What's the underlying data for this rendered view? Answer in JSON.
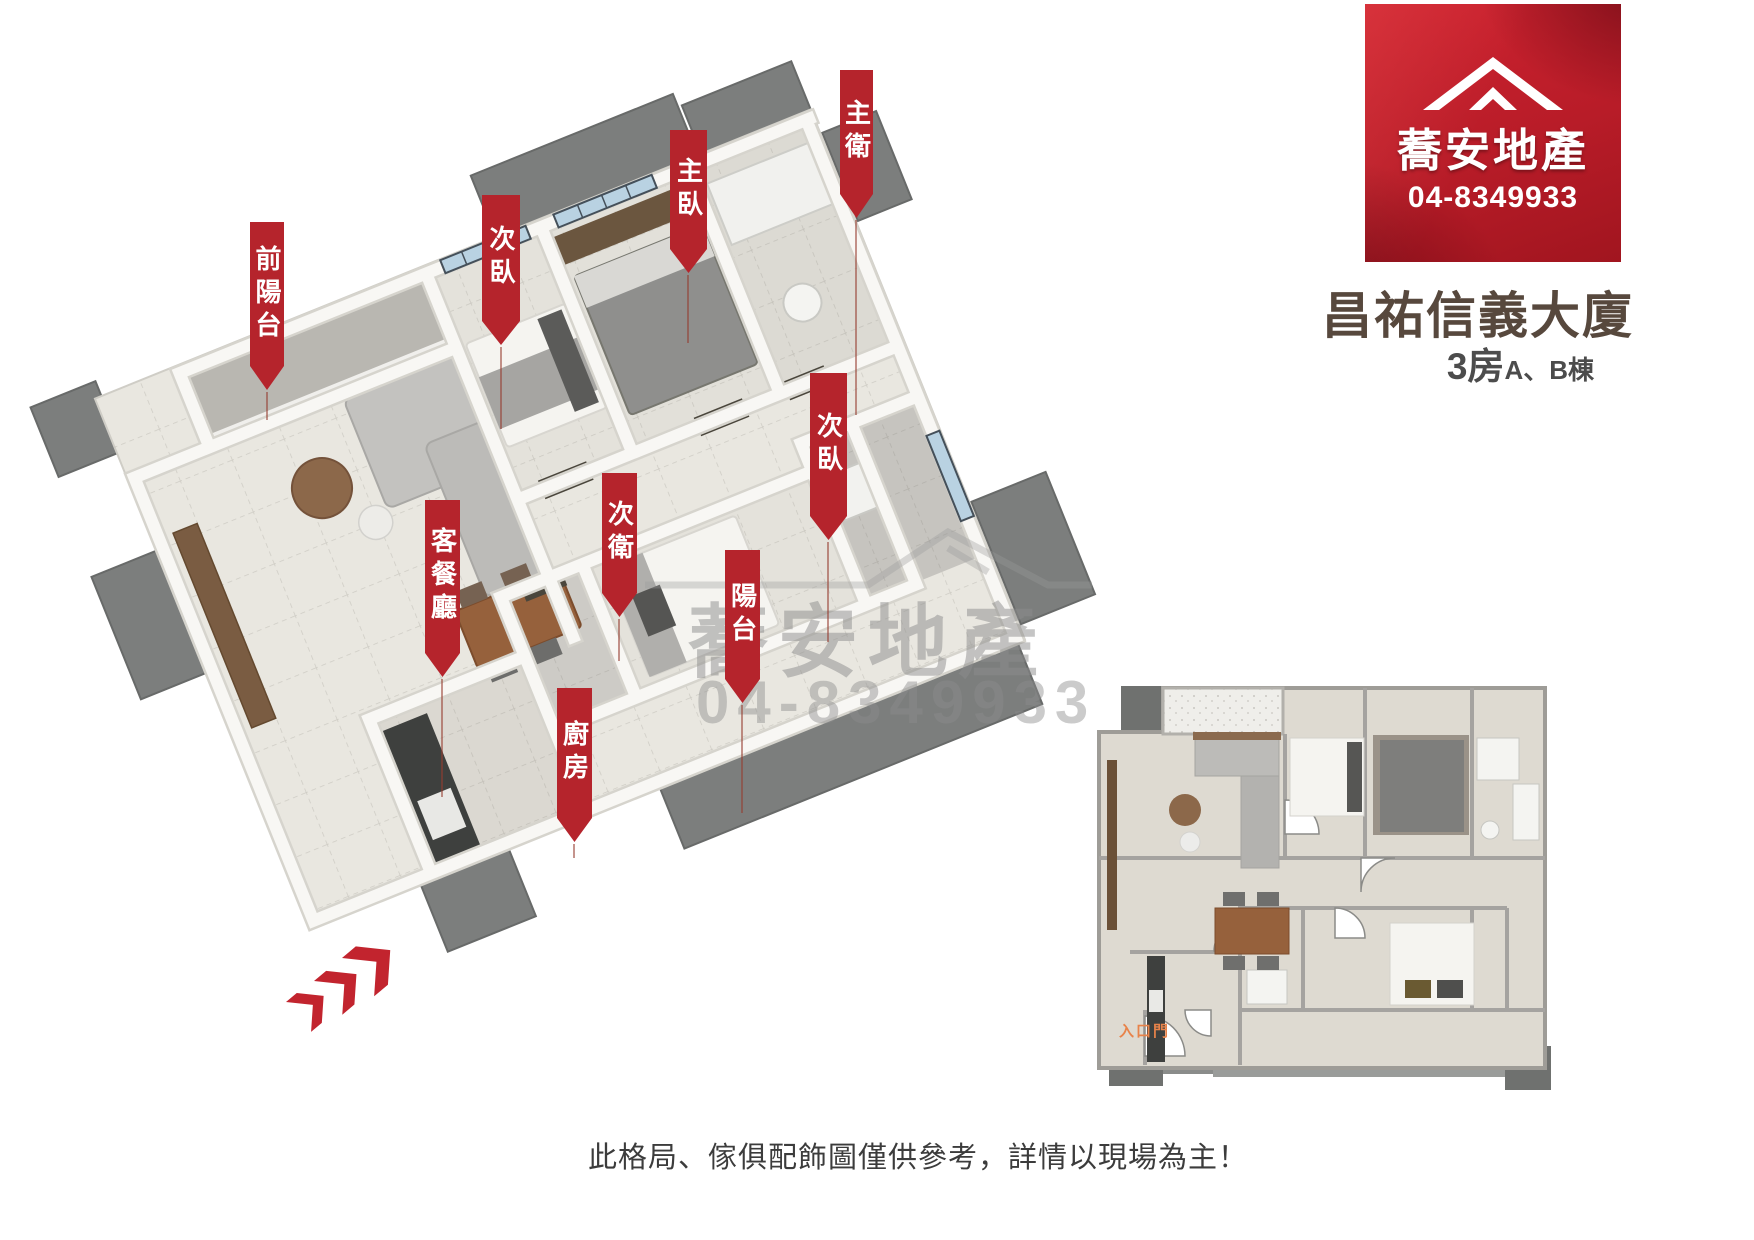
{
  "logo": {
    "brand": "蕎安地產",
    "phone": "04-8349933"
  },
  "header": {
    "title": "昌祐信義大廈",
    "rooms": "3房",
    "buildings": "A、B棟"
  },
  "banners": [
    {
      "label": "前陽台"
    },
    {
      "label": "次臥"
    },
    {
      "label": "主臥"
    },
    {
      "label": "主衛"
    },
    {
      "label": "次臥"
    },
    {
      "label": "客餐廳"
    },
    {
      "label": "次衛"
    },
    {
      "label": "陽台"
    },
    {
      "label": "廚房"
    }
  ],
  "watermark": {
    "brand": "蕎安地產",
    "phone": "04-8349933"
  },
  "floorplan_2d": {
    "entrance_label": "入口門"
  },
  "footer": {
    "caption": "此格局、傢俱配飾圖僅供參考，詳情以現場為主！"
  },
  "colors": {
    "banner_red": "#b5242c",
    "logo_red": "#c0202b",
    "title_brown": "#57483d",
    "watermark_gray": "#8d8d8d",
    "entrance_orange": "#e8834a"
  }
}
